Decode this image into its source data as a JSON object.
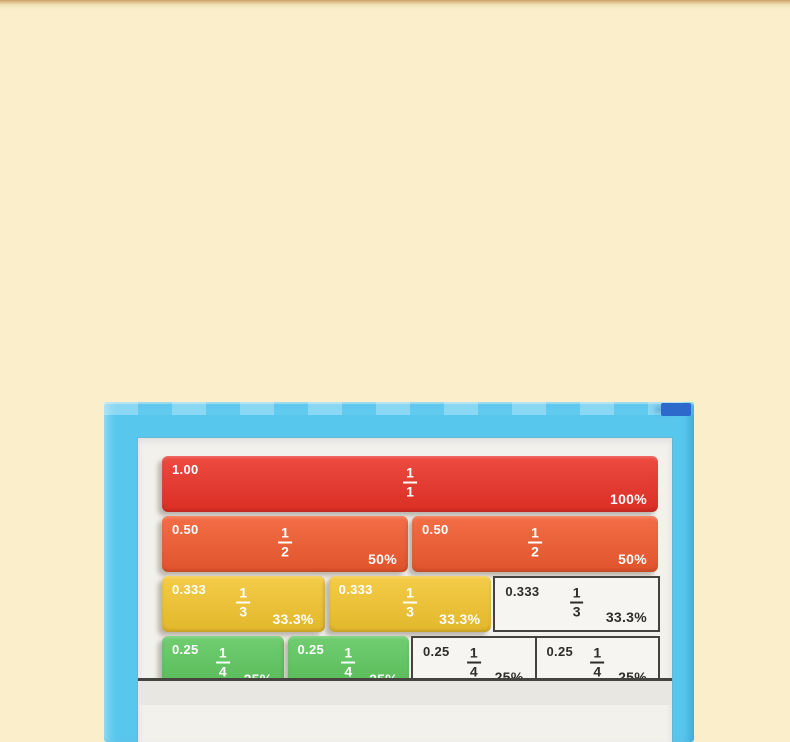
{
  "scene": {
    "background_color": "#faefca",
    "top_strip_color": "#c9a368",
    "description_colors": {
      "board_frame_blue": "#58c7ee",
      "corner_accent_blue": "#2d68cb",
      "panel_white": "#f3f1ec",
      "tile_red": "#ea3227",
      "tile_orange": "#f15a2e",
      "tile_yellow": "#f3c52f",
      "tile_green": "#5dc75d",
      "slot_border_dark": "#45433e"
    }
  },
  "board": {
    "rows": [
      {
        "cells": [
          {
            "kind": "tile",
            "color": "#ea3227",
            "decimal": "1.00",
            "numerator": "1",
            "denominator": "1",
            "percent": "100%",
            "span": 12
          }
        ]
      },
      {
        "cells": [
          {
            "kind": "tile",
            "color": "#f15a2e",
            "decimal": "0.50",
            "numerator": "1",
            "denominator": "2",
            "percent": "50%",
            "span": 6
          },
          {
            "kind": "tile",
            "color": "#f15a2e",
            "decimal": "0.50",
            "numerator": "1",
            "denominator": "2",
            "percent": "50%",
            "span": 6
          }
        ]
      },
      {
        "cells": [
          {
            "kind": "tile",
            "color": "#f3c52f",
            "decimal": "0.333",
            "numerator": "1",
            "denominator": "3",
            "percent": "33.3%",
            "span": 4
          },
          {
            "kind": "tile",
            "color": "#f3c52f",
            "decimal": "0.333",
            "numerator": "1",
            "denominator": "3",
            "percent": "33.3%",
            "span": 4
          },
          {
            "kind": "slot",
            "decimal": "0.333",
            "numerator": "1",
            "denominator": "3",
            "percent": "33.3%",
            "span": 4
          }
        ]
      },
      {
        "cells": [
          {
            "kind": "tile",
            "color": "#5dc75d",
            "decimal": "0.25",
            "numerator": "1",
            "denominator": "4",
            "percent": "25%",
            "span": 3
          },
          {
            "kind": "tile",
            "color": "#5dc75d",
            "decimal": "0.25",
            "numerator": "1",
            "denominator": "4",
            "percent": "25%",
            "span": 3
          },
          {
            "kind": "slot",
            "decimal": "0.25",
            "numerator": "1",
            "denominator": "4",
            "percent": "25%",
            "span": 3
          },
          {
            "kind": "slot",
            "decimal": "0.25",
            "numerator": "1",
            "denominator": "4",
            "percent": "25%",
            "span": 3
          }
        ]
      }
    ]
  }
}
